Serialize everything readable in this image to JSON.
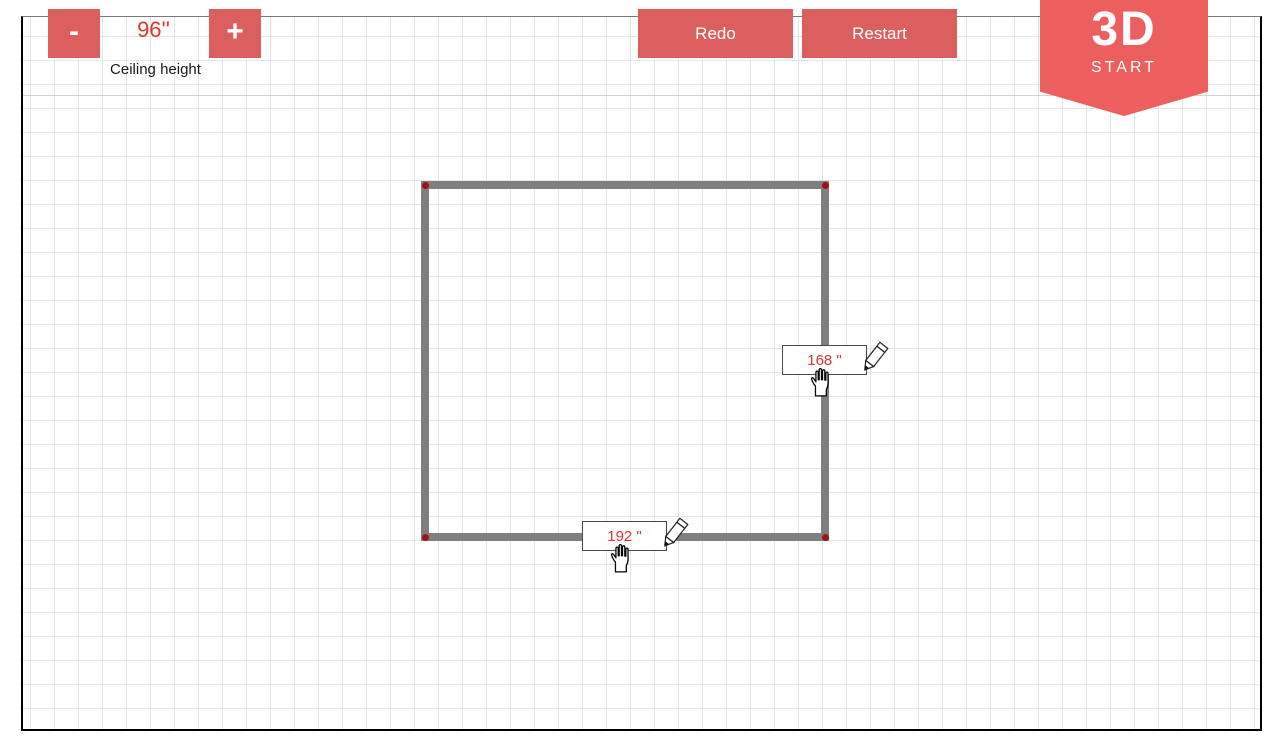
{
  "toolbar": {
    "ceiling_height": {
      "decrease_label": "-",
      "value": "96''",
      "increase_label": "+",
      "label": "Ceiling height"
    },
    "redo_label": "Redo",
    "restart_label": "Restart",
    "start_badge": {
      "title": "3D",
      "subtitle": "START"
    }
  },
  "canvas": {
    "room": {
      "bottom_wall_length": "192 \"",
      "right_wall_length": "168 \""
    },
    "icons": {
      "pencil": "pencil-icon",
      "hand_cursor": "grab-hand-icon"
    }
  },
  "colors": {
    "accent_red": "#db5f5f",
    "badge_red": "#ed5e5e",
    "dimension_text_red": "#e23429",
    "wall_gray": "#7f7f7f",
    "corner_dot_red": "#a31212",
    "grid_line": "#e4e4e4"
  }
}
